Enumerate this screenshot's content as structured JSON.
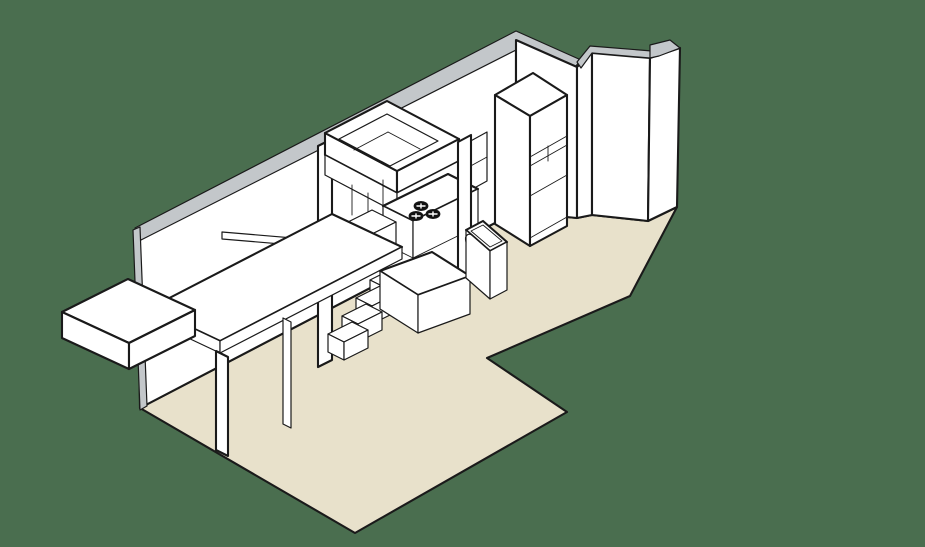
{
  "title": "isometric-kitchen-studio-axonometric-illustration",
  "colors": {
    "background": "#4a6e4f",
    "floor": "#e8e1cb",
    "wall_top": "#c3c7ca",
    "furniture": "#ffffff",
    "outline": "#1a1a1a",
    "burner": "#111111"
  },
  "scene": {
    "type": "isometric-cutaway-drawing",
    "room": "studio-kitchen",
    "objects": [
      "floor-slab",
      "left-wall",
      "right-wall",
      "angled-bay-panels",
      "tall-cabinet-fridge",
      "wall-cabinet",
      "loft-box",
      "range-hood",
      "cooktop-burners",
      "kitchen-base-cabinet",
      "stairs",
      "stair-landing",
      "stair-railing",
      "desk-counter",
      "bench",
      "side-table",
      "sink-unit",
      "faucet"
    ]
  }
}
